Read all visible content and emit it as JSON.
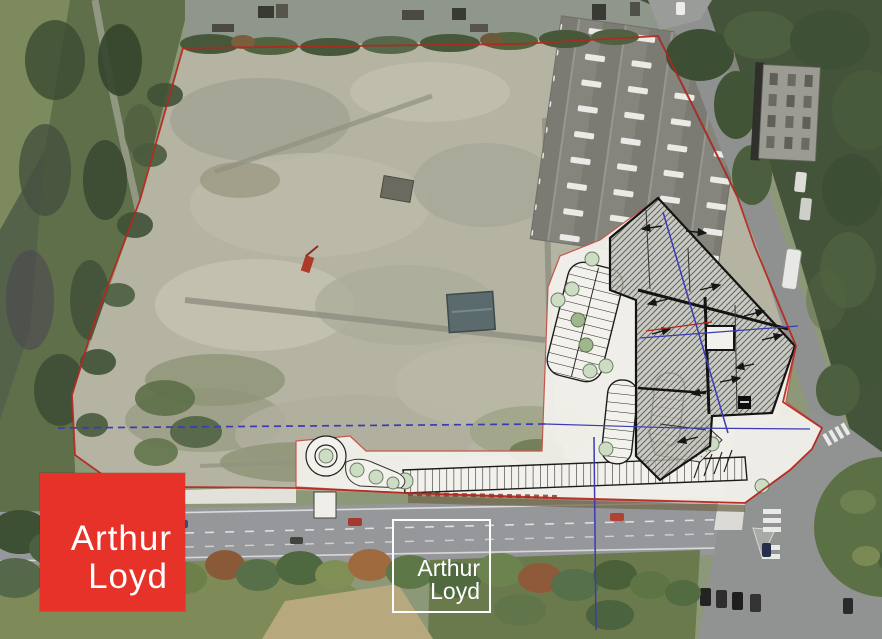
{
  "branding": {
    "logo": {
      "line1": "Arthur",
      "line2": "Loyd",
      "background_color": "#e63229",
      "text_color": "#ffffff"
    },
    "watermark": {
      "line1": "Arthur",
      "line2": "Loyd",
      "border_color": "#ffffff",
      "text_color": "#ffffff"
    }
  },
  "overlay_colors": {
    "site_boundary_red": "#b5271d",
    "plan_fill_white": "#f2f1ec",
    "building_outline_black": "#141414",
    "parcel_line_blue": "#3b3bb4",
    "plan_tree_green": "#cdddc4"
  }
}
